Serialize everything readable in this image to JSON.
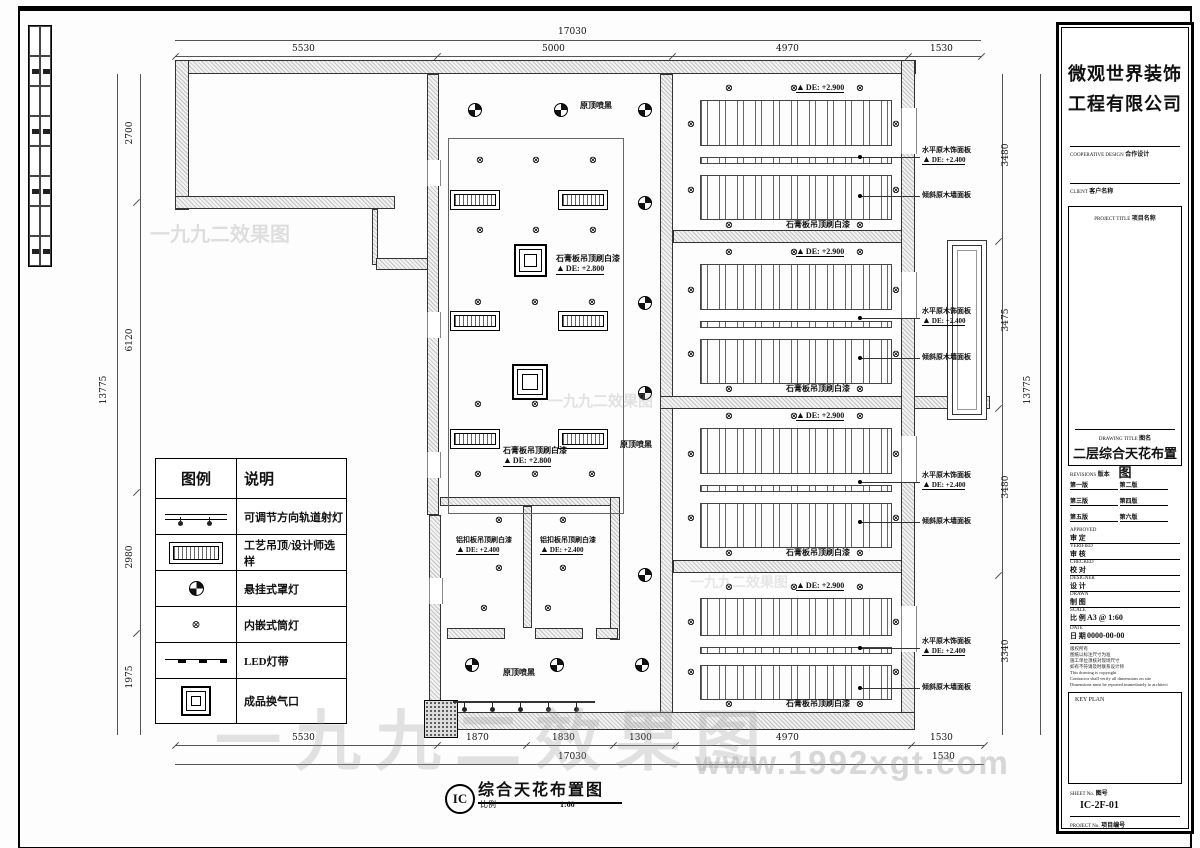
{
  "sheet": {
    "watermark_text": "一九九二效果图",
    "watermark_url": "www.1992xgt.com"
  },
  "drawing_label": {
    "code": "IC",
    "title": "综合天花布置图",
    "scale_label": "比例",
    "scale": "1:60"
  },
  "dimensions": {
    "top_total": "17030",
    "top": [
      "5530",
      "5000",
      "4970",
      "1530"
    ],
    "bottom": [
      "5530",
      "1870",
      "1830",
      "1300",
      "4970",
      "1530"
    ],
    "bottom_total": "17030",
    "bottom_right": "1530",
    "left_total": "13775",
    "left": [
      "2700",
      "6120",
      "2980",
      "1975"
    ],
    "right": [
      "3480",
      "3475",
      "3480",
      "3340"
    ],
    "right_total": "13775"
  },
  "plan": {
    "ceiling_black": "原顶喷黑",
    "gypsum": "石膏板吊顶刷白漆",
    "lvl_280": "DE: +2.800",
    "alum": "铝扣板吊顶刷白漆",
    "lvl_240": "DE: +2.400",
    "lvl_290": "DE: +2.900",
    "callout_h": "水平原木饰面板",
    "callout_h_lvl": "DE: +2.400",
    "callout_s": "倾斜原木墙面板"
  },
  "legend": {
    "headers": [
      "图例",
      "说明"
    ],
    "rows": [
      {
        "symbol": "track-light",
        "desc": "可调节方向轨道射灯"
      },
      {
        "symbol": "craft-ceiling",
        "desc": "工艺吊顶/设计师选样"
      },
      {
        "symbol": "pendant-lamp",
        "desc": "悬挂式罩灯"
      },
      {
        "symbol": "recessed-downlight",
        "desc": "内嵌式筒灯"
      },
      {
        "symbol": "led-strip",
        "desc": "LED灯带"
      },
      {
        "symbol": "air-vent",
        "desc": "成品换气口"
      }
    ]
  },
  "title_block": {
    "company_line1": "微观世界装饰",
    "company_line2": "工程有限公司",
    "cooperative_en": "COOPERATIVE DESIGN",
    "cooperative_zh": "合作设计",
    "client_en": "CLIENT",
    "client_zh": "客户名称",
    "project_title_en": "PROJECT TITLE",
    "project_title_zh": "项目名称",
    "drawing_title_en": "DRAWING TITLE",
    "drawing_title_zh": "图名",
    "drawing_title": "二层综合天花布置图",
    "revisions_en": "REVISIONS",
    "revisions_zh": "版本",
    "revisions": [
      "第一版",
      "第二版",
      "第三版",
      "第四版",
      "第五版",
      "第六版"
    ],
    "signoff": [
      {
        "en": "APPROVED",
        "zh": "审 定"
      },
      {
        "en": "VERIFIED",
        "zh": "审 核"
      },
      {
        "en": "CHECKED",
        "zh": "校 对"
      },
      {
        "en": "DESIGNER",
        "zh": "设 计"
      },
      {
        "en": "DRAWN",
        "zh": "制 图"
      }
    ],
    "scale_en": "SCALE",
    "scale_zh": "比 例",
    "scale_value": "A3 @ 1:60",
    "date_en": "DATE",
    "date_zh": "日 期",
    "date_value": "0000-00-00",
    "notes": [
      "版权所有",
      "图纸以标注尺寸为准",
      "施工单位须核对现场尺寸",
      "如有不符请及时联系设计师",
      "This drawing is copyright",
      "Contractor shall verify all dimensions on site",
      "Dimensions must be reported immediately to architect"
    ],
    "key_plan": "KEY PLAN",
    "sheet_no_en": "SHEET No.",
    "sheet_no_zh": "图号",
    "sheet_no": "IC-2F-01",
    "project_no_en": "PROJECT No.",
    "project_no_zh": "项目编号"
  }
}
